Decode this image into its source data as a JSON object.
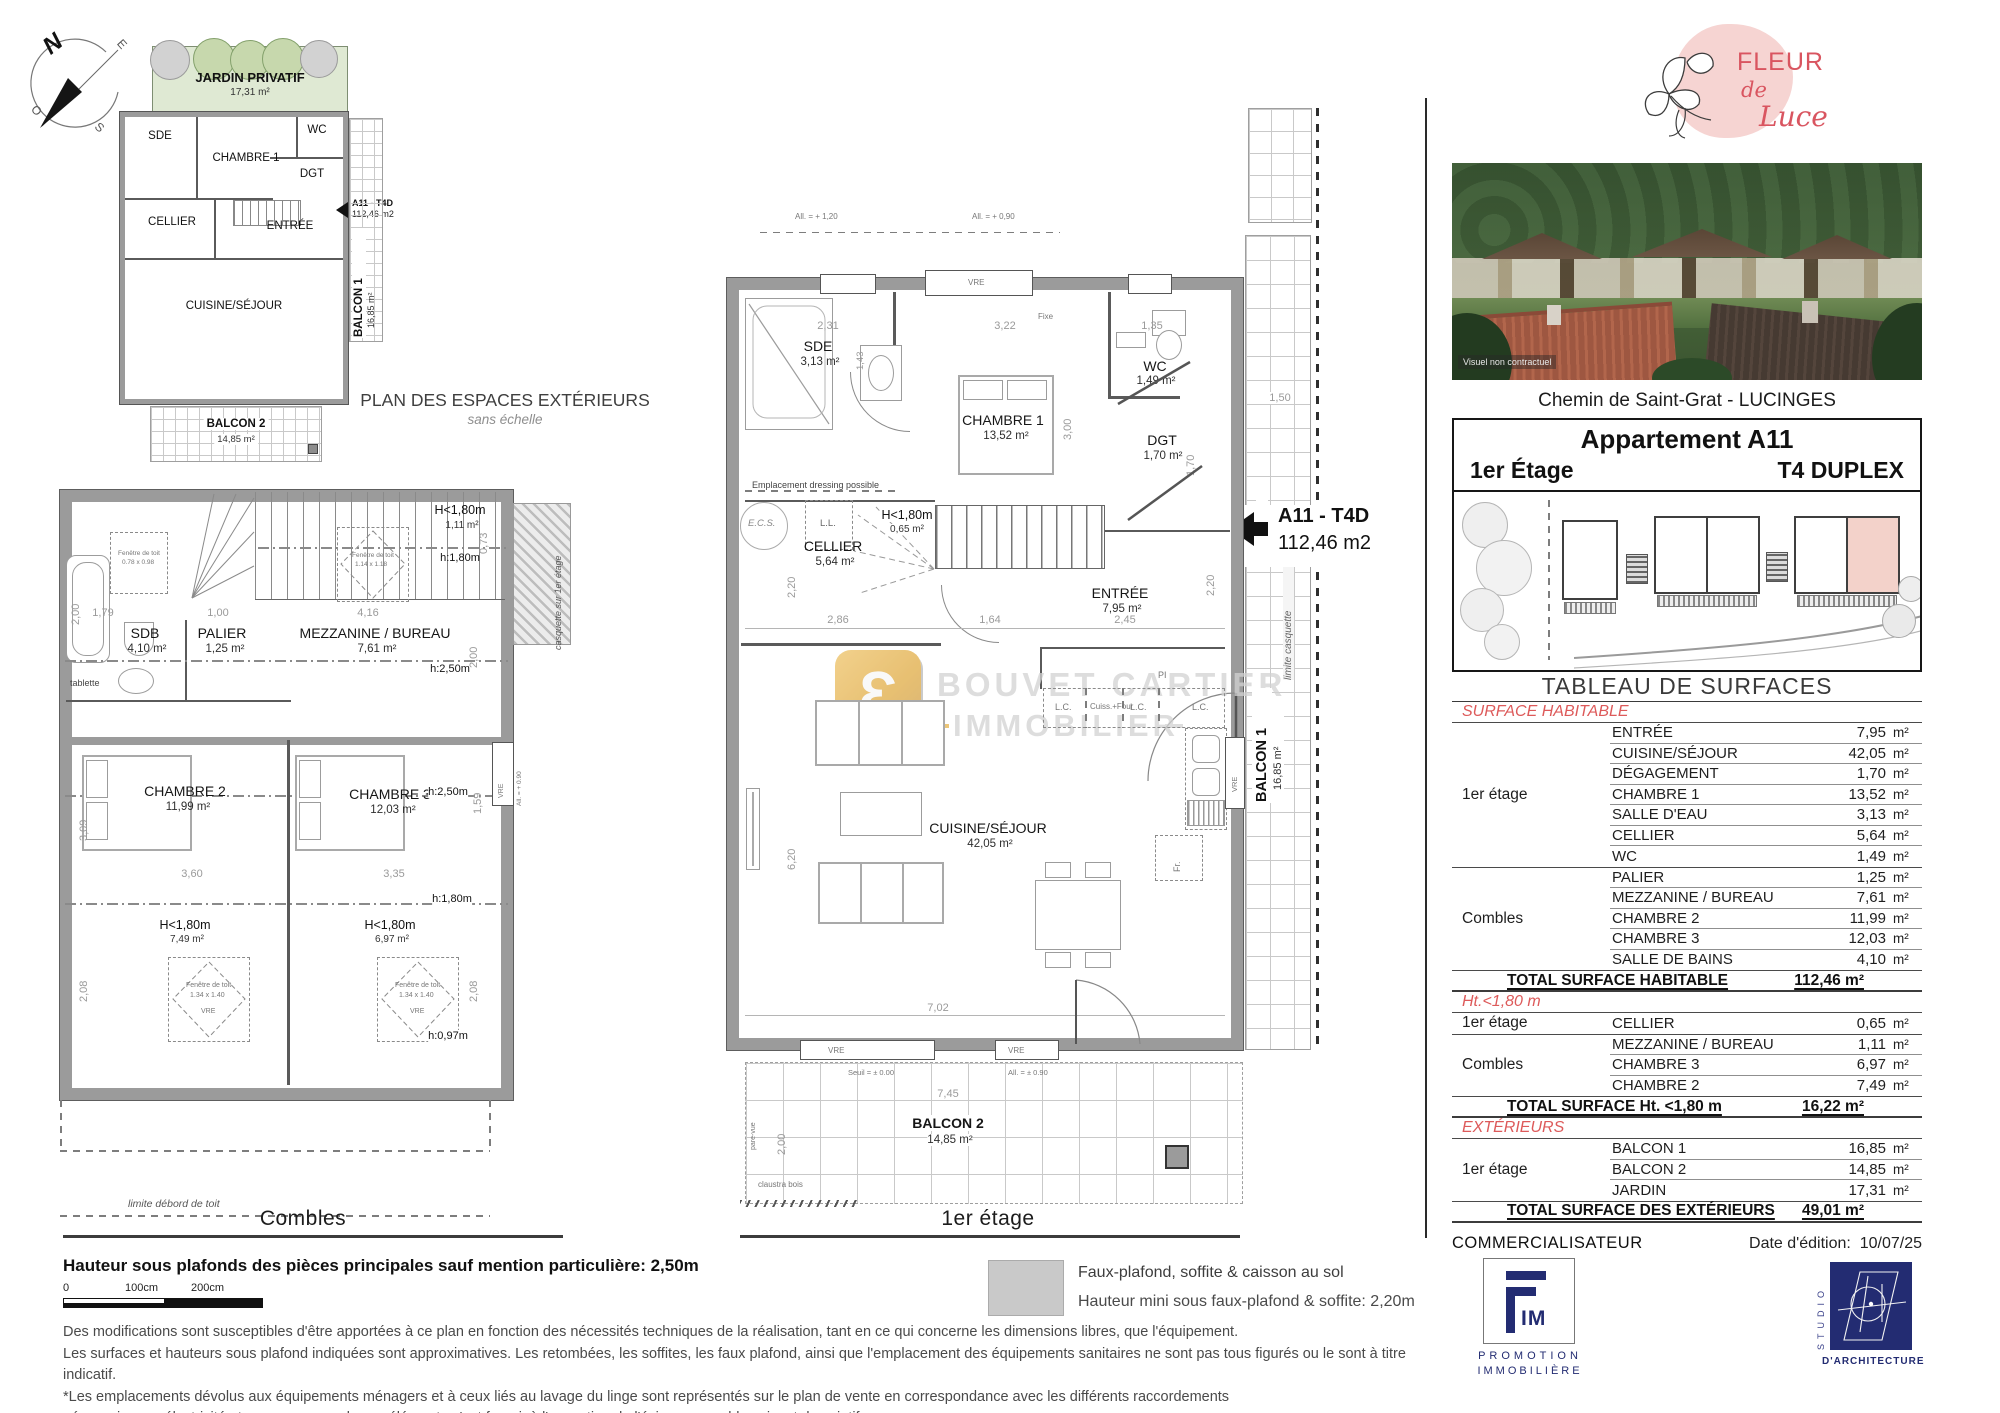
{
  "compass": {
    "n": "N",
    "e": "E",
    "s": "S",
    "o": "O"
  },
  "exterior_plan": {
    "title": "PLAN DES ESPACES EXTÉRIEURS",
    "subtitle": "sans échelle",
    "jardin": "JARDIN PRIVATIF",
    "jardin_area": "17,31 m²",
    "sde": "SDE",
    "chambre1": "CHAMBRE 1",
    "wc": "WC",
    "dgt": "DGT",
    "cellier": "CELLIER",
    "entree": "ENTRÉE",
    "cuisine": "CUISINE/SÉJOUR",
    "balcon1": "BALCON 1",
    "balcon1_area": "16,85 m²",
    "balcon2": "BALCON 2",
    "balcon2_area": "14,85 m²",
    "unit_ref": "A11 - T4D",
    "unit_area": "112,46 m2"
  },
  "combles": {
    "caption": "Combles",
    "sdb": "SDB",
    "sdb_area": "4,10 m²",
    "palier": "PALIER",
    "palier_area": "1,25 m²",
    "mezzanine": "MEZZANINE / BUREAU",
    "mezzanine_area": "7,61 m²",
    "chambre2": "CHAMBRE 2",
    "chambre2_area": "11,99 m²",
    "chambre3": "CHAMBRE 3",
    "chambre3_area": "12,03 m²",
    "h180_a": "H<1,80m",
    "h180_a_area": "1,11 m²",
    "h180_b": "H<1,80m",
    "h180_b_area": "7,49 m²",
    "h180_c": "H<1,80m",
    "h180_c_area": "6,97 m²",
    "line_h180": "h:1,80m",
    "line_h250": "h:2,50m",
    "line_h097": "h:0,97m",
    "tablette": "tablette",
    "casquette": "casquette sur 1er étage",
    "limite": "limite débord de toit",
    "fen": "Fenêtre de toit",
    "fen_a": "0.78 x 0.98",
    "fen_b": "1.14 x 1.18",
    "fen_c": "1.34 x 1.40",
    "vre": "VRE",
    "all090": "All. = + 0.90",
    "d200a": "2,00",
    "d179": "1,79",
    "d100": "1,00",
    "d416": "4,16",
    "d073": "0,73",
    "d200b": "2,00",
    "d309": "3,09",
    "d159": "1,59",
    "d360": "3,60",
    "d335": "3,35",
    "d208a": "2,08",
    "d208b": "2,08"
  },
  "first_floor": {
    "caption": "1er étage",
    "sde": "SDE",
    "sde_area": "3,13 m²",
    "chambre1": "CHAMBRE 1",
    "chambre1_area": "13,52 m²",
    "wc": "WC",
    "wc_area": "1,49 m²",
    "dgt": "DGT",
    "dgt_area": "1,70 m²",
    "cellier": "CELLIER",
    "cellier_area": "5,64 m²",
    "h180": "H<1,80m",
    "h180_area": "0,65 m²",
    "entree": "ENTRÉE",
    "entree_area": "7,95 m²",
    "cuisine": "CUISINE/SÉJOUR",
    "cuisine_area": "42,05 m²",
    "balcon1": "BALCON 1",
    "balcon1_area": "16,85 m²",
    "balcon2": "BALCON 2",
    "balcon2_area": "14,85 m²",
    "unit_ref": "A11 - T4D",
    "unit_area": "112,46 m2",
    "ecs": "E.C.S.",
    "ll": "L.L.",
    "dressing": "Emplacement dressing possible",
    "lc": "L.C.",
    "cuiss": "Cuiss.+Four",
    "pi": "PI",
    "fr": "Fr.",
    "vre": "VRE",
    "fixe": "Fixe",
    "seuil": "Seuil = ± 0.00",
    "all090": "All. = ± 0.90",
    "all090b": "All. = + 0,90",
    "all120": "All. = + 1,20",
    "claustra": "claustra bois",
    "parevue": "pare-vue",
    "limite_casquette": "limite casquette",
    "d231": "2,31",
    "d322": "3,22",
    "d135": "1,35",
    "d143": "1,43",
    "d300": "3,00",
    "d170": "1,70",
    "d220a": "2,20",
    "d286": "2,86",
    "d164": "1,64",
    "d245": "2,45",
    "d620": "6,20",
    "d702": "7,02",
    "d745": "7,45",
    "d200": "2,00",
    "d150": "1,50",
    "d1123": "11,23",
    "d220b": "2,20"
  },
  "watermark": {
    "line1": "BOUVET CARTIER",
    "line2": "IMMOBILIER"
  },
  "legend": {
    "line1": "Faux-plafond, soffite & caisson au sol",
    "line2": "Hauteur mini sous faux-plafond & soffite: 2,20m"
  },
  "footer": {
    "height_note": "Hauteur sous plafonds des pièces principales sauf mention particulière: 2,50m",
    "scale0": "0",
    "scale100": "100cm",
    "scale200": "200cm",
    "disclaimer1": "Des modifications sont susceptibles d'être apportées à ce plan en fonction des nécessités techniques de la réalisation, tant en ce qui concerne les dimensions libres, que l'équipement.",
    "disclaimer2": "Les surfaces et hauteurs sous plafond indiquées sont approximatives. Les retombées, les soffites, les faux plafond, ainsi que l'emplacement des équipements sanitaires ne sont pas tous figurés ou le sont à titre indicatif.",
    "disclaimer3": "*Les emplacements dévolus aux équipements ménagers et à ceux liés au lavage du linge sont représentés sur le plan de vente en correspondance avec les différents raccordements",
    "disclaimer4": "nécessaires en électricité et en eau, aucun de ces éléments n'est fourni, à l'exception de l'évier sur meuble suivant descriptif."
  },
  "right_panel": {
    "brand1": "FLEUR",
    "brand2": "de",
    "brand3": "Luce",
    "photo_caption": "Visuel non contractuel",
    "address": "Chemin de Saint-Grat - LUCINGES",
    "title": "Appartement A11",
    "floor": "1er Étage",
    "type": "T4 DUPLEX",
    "table_title": "TABLEAU DE SURFACES",
    "unit": "m²",
    "sections": [
      {
        "header": "SURFACE HABITABLE",
        "groups": [
          {
            "name": "1er étage",
            "rows": [
              [
                "ENTRÉE",
                "7,95"
              ],
              [
                "CUISINE/SÉJOUR",
                "42,05"
              ],
              [
                "DÉGAGEMENT",
                "1,70"
              ],
              [
                "CHAMBRE 1",
                "13,52"
              ],
              [
                "SALLE D'EAU",
                "3,13"
              ],
              [
                "CELLIER",
                "5,64"
              ],
              [
                "WC",
                "1,49"
              ]
            ]
          },
          {
            "name": "Combles",
            "rows": [
              [
                "PALIER",
                "1,25"
              ],
              [
                "MEZZANINE / BUREAU",
                "7,61"
              ],
              [
                "CHAMBRE 2",
                "11,99"
              ],
              [
                "CHAMBRE 3",
                "12,03"
              ],
              [
                "SALLE DE BAINS",
                "4,10"
              ]
            ]
          }
        ],
        "total_label": "TOTAL SURFACE HABITABLE",
        "total_value": "112,46 m²"
      },
      {
        "header": "Ht.<1,80 m",
        "groups": [
          {
            "name": "1er étage",
            "rows": [
              [
                "CELLIER",
                "0,65"
              ]
            ]
          },
          {
            "name": "Combles",
            "rows": [
              [
                "MEZZANINE / BUREAU",
                "1,11"
              ],
              [
                "CHAMBRE 3",
                "6,97"
              ],
              [
                "CHAMBRE 2",
                "7,49"
              ]
            ]
          }
        ],
        "total_label": "TOTAL SURFACE Ht. <1,80 m",
        "total_value": "16,22 m²"
      },
      {
        "header": "EXTÉRIEURS",
        "groups": [
          {
            "name": "1er étage",
            "rows": [
              [
                "BALCON 1",
                "16,85"
              ],
              [
                "BALCON 2",
                "14,85"
              ],
              [
                "JARDIN",
                "17,31"
              ]
            ]
          }
        ],
        "total_label": "TOTAL SURFACE DES EXTÉRIEURS",
        "total_value": "49,01 m²"
      }
    ],
    "commercialisateur": "COMMERCIALISATEUR",
    "edition_label": "Date d'édition:",
    "edition_value": "10/07/25",
    "fim_im": "IM",
    "fim_line1": "PROMOTION",
    "fim_line2": "IMMOBILIÈRE",
    "studio_side": "STUDIO",
    "studio_bottom": "D'ARCHITECTURE"
  },
  "colors": {
    "accent_red": "#dd5a5a",
    "navy": "#232c72",
    "wall": "#9b9b9b",
    "jardin": "#dfe9d3",
    "gold": "#e6b44c",
    "unit_pink": "#f3d2ca",
    "brand_pink": "#f6d4d2",
    "brand_red": "#d95560"
  }
}
